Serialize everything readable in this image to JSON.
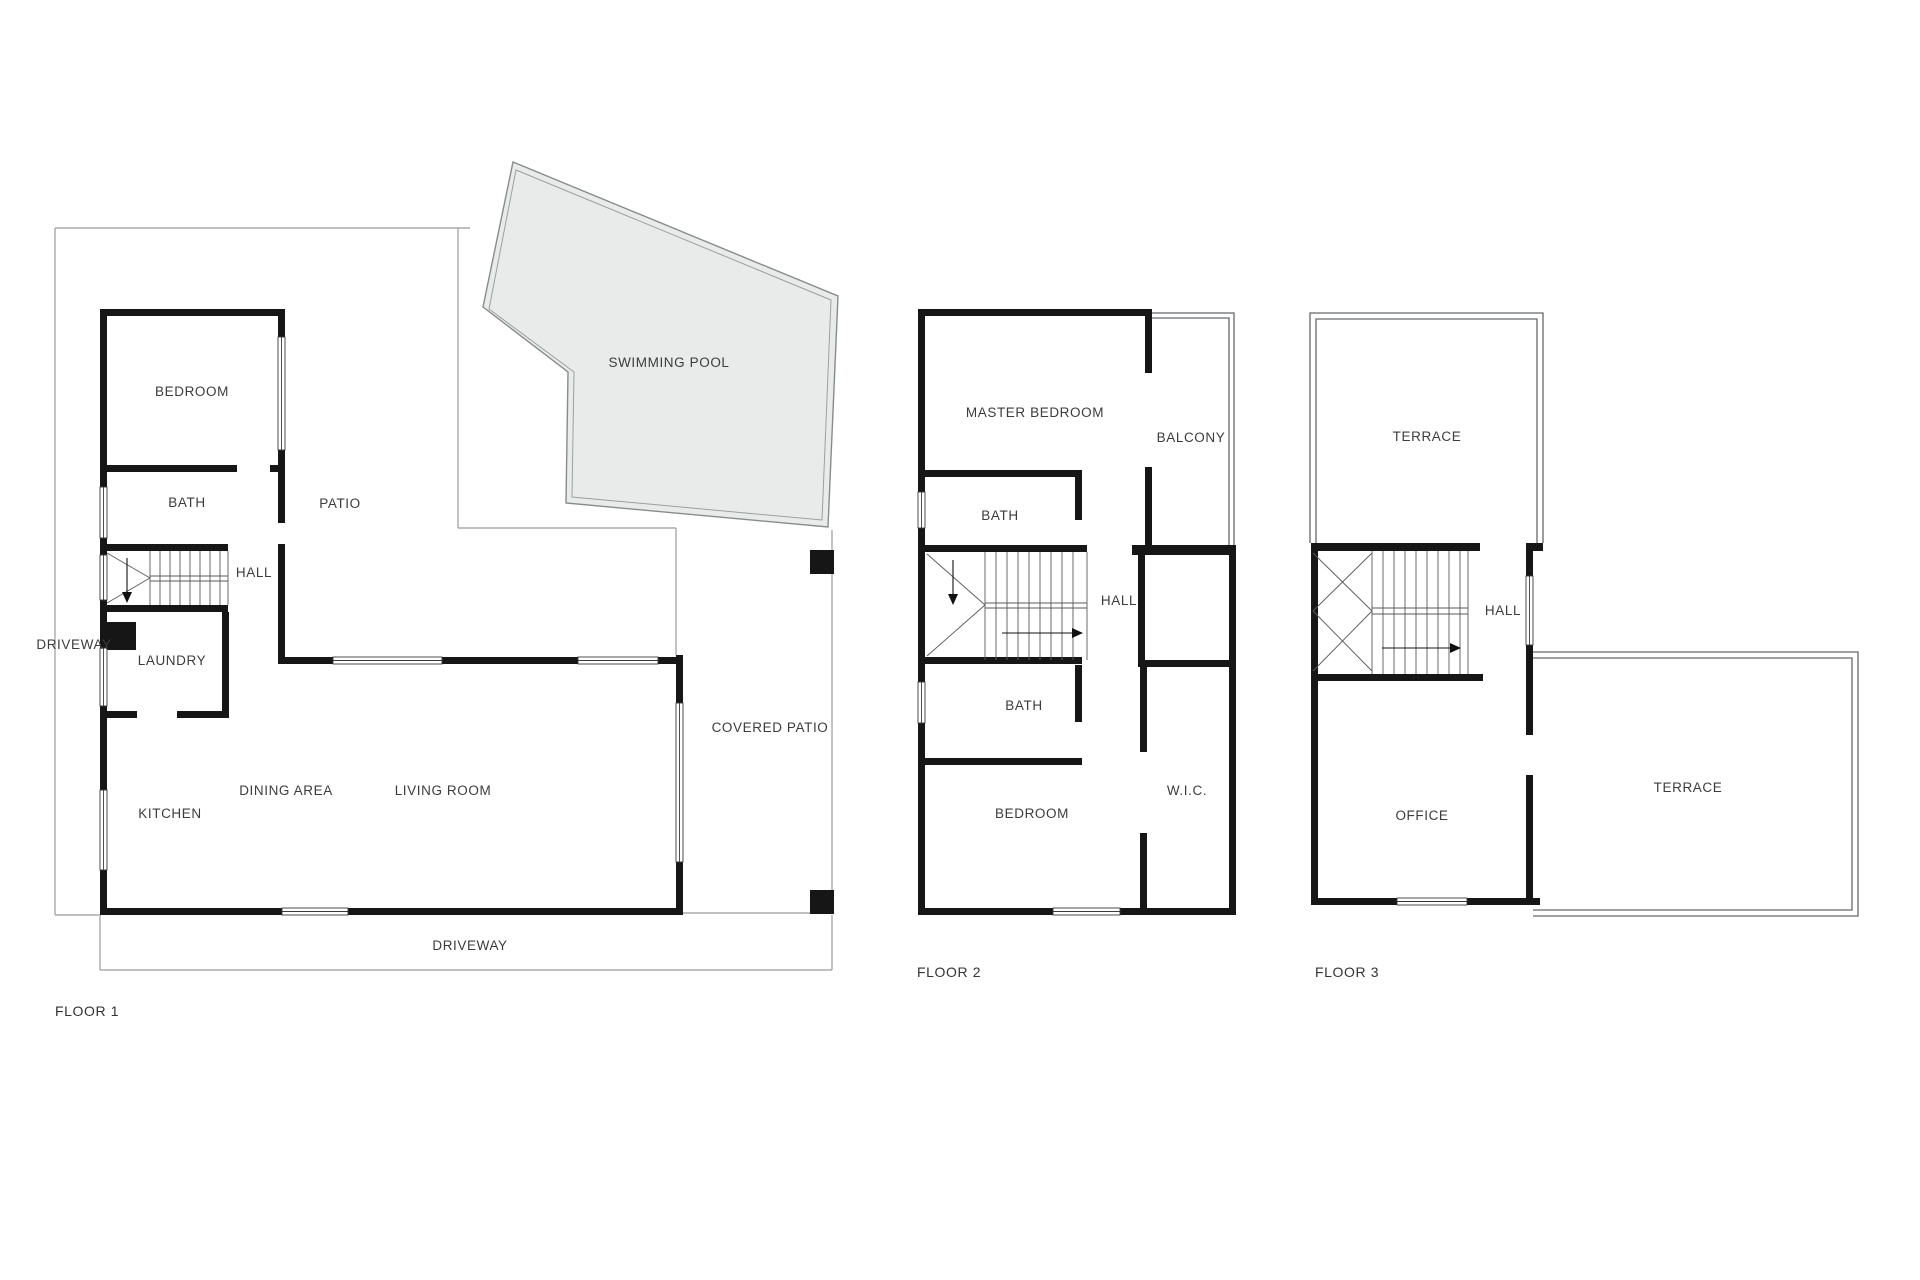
{
  "diagram": {
    "type": "residential floor plan, 3 levels",
    "colors": {
      "wall": "#161616",
      "pool_fill": "#e9ebea",
      "site_line": "#9b9b9b",
      "label_text": "#3c3c3c"
    }
  },
  "floor1": {
    "caption": "FLOOR 1",
    "bedroom": "BEDROOM",
    "bath": "BATH",
    "hall": "HALL",
    "laundry": "LAUNDRY",
    "driveway_side": "DRIVEWAY",
    "kitchen": "KITCHEN",
    "dining": "DINING AREA",
    "living": "LIVING ROOM",
    "patio": "PATIO",
    "swimming_pool": "SWIMMING POOL",
    "covered_patio": "COVERED PATIO",
    "driveway_bottom": "DRIVEWAY"
  },
  "floor2": {
    "caption": "FLOOR 2",
    "master_bedroom": "MASTER BEDROOM",
    "balcony": "BALCONY",
    "bath_upper": "BATH",
    "hall": "HALL",
    "bath_lower": "BATH",
    "bedroom": "BEDROOM",
    "wic": "W.I.C."
  },
  "floor3": {
    "caption": "FLOOR 3",
    "terrace_upper": "TERRACE",
    "hall": "HALL",
    "office": "OFFICE",
    "terrace_lower": "TERRACE"
  }
}
